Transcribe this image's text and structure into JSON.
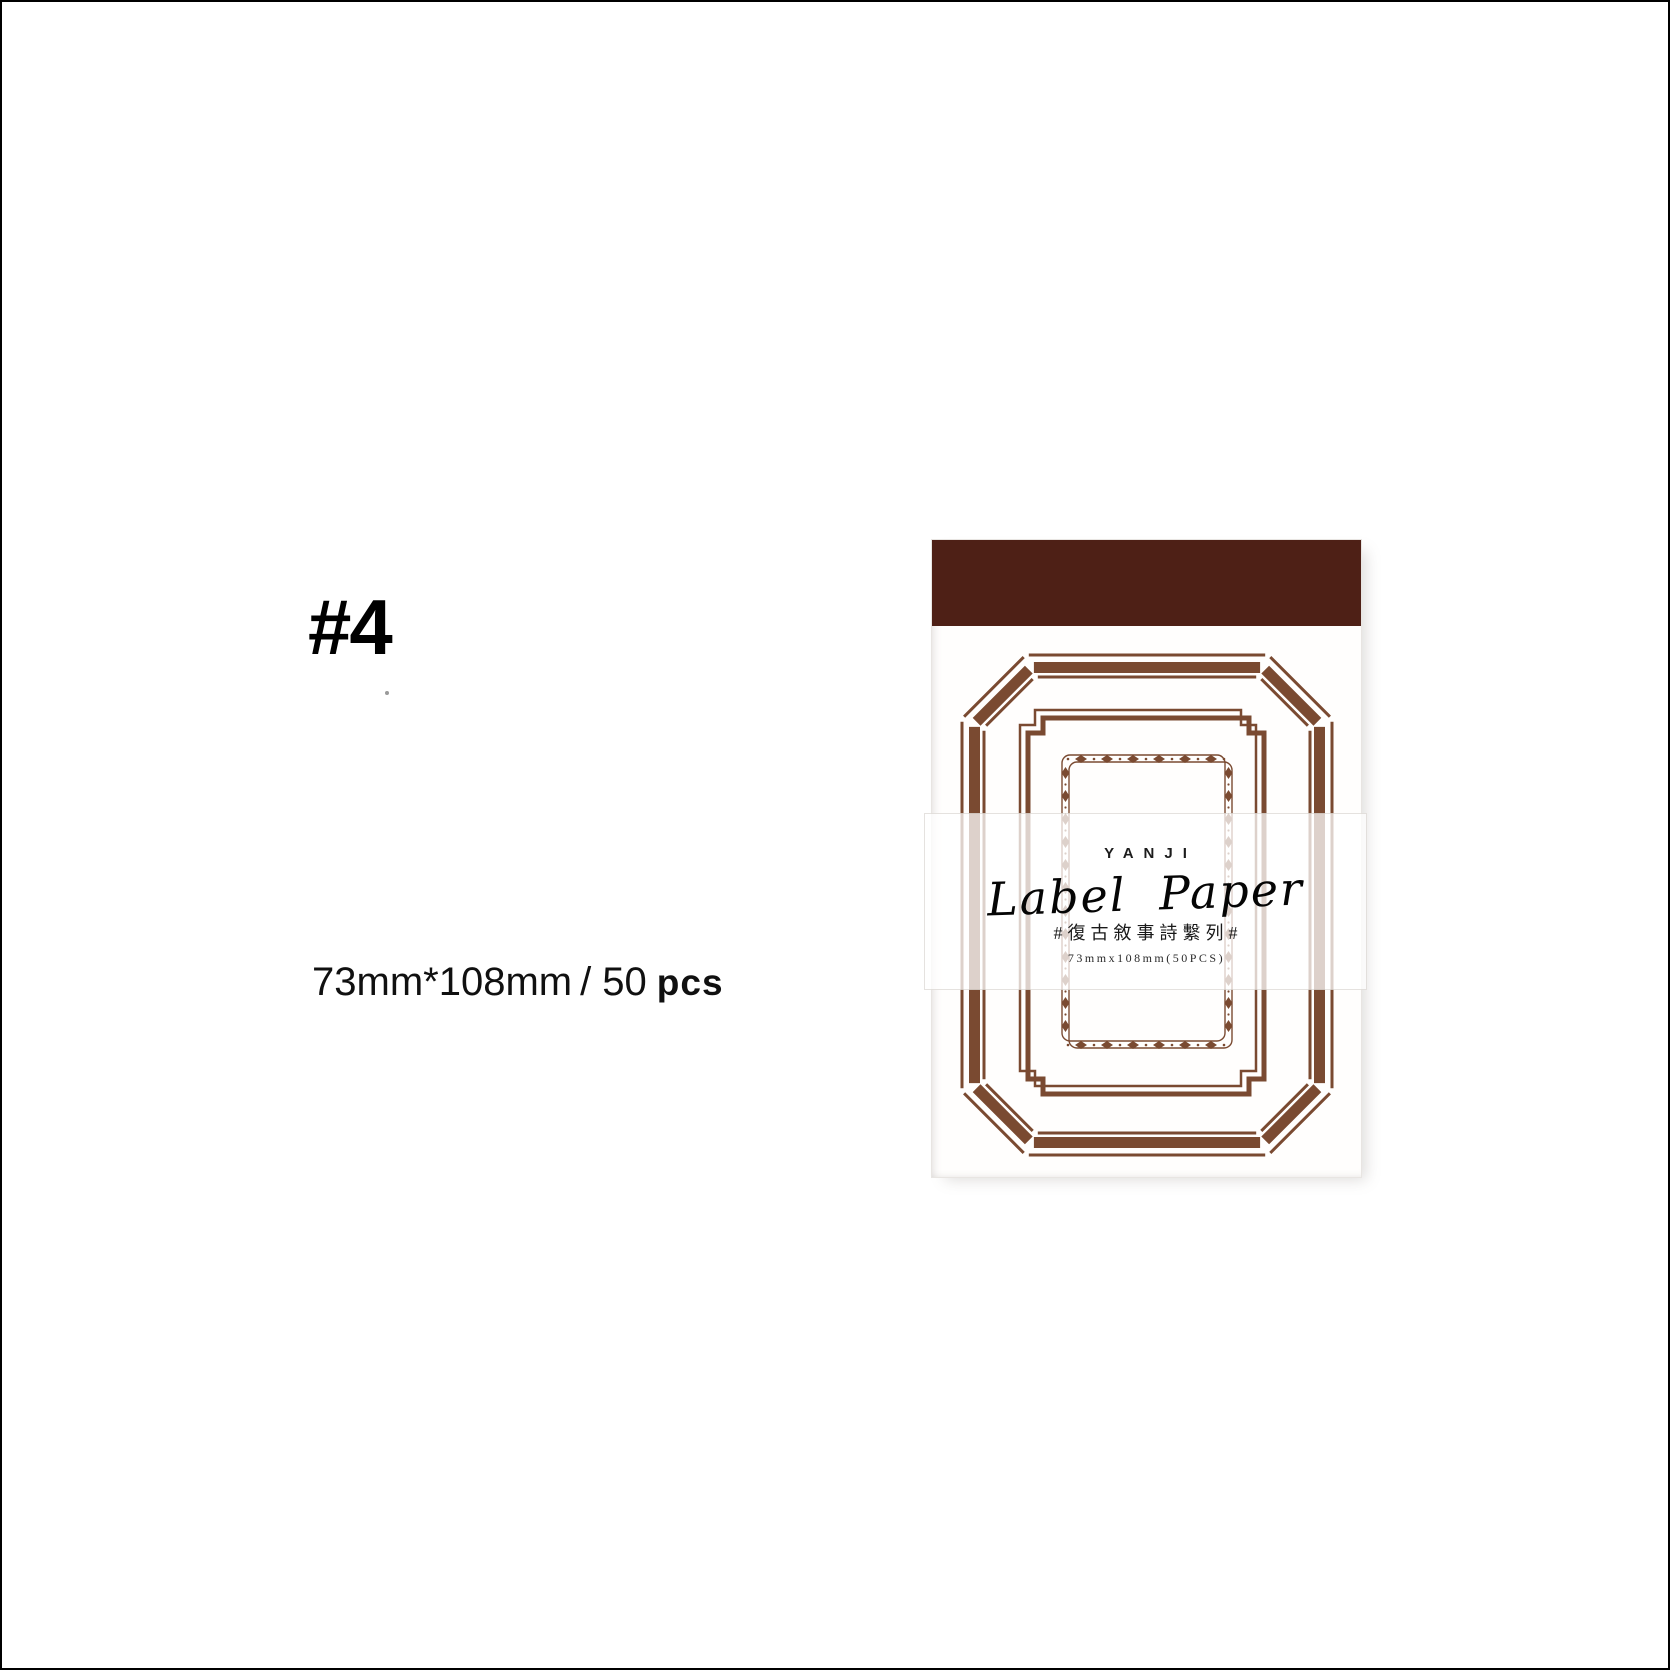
{
  "page": {
    "background": "#ffffff",
    "border_color": "#000000"
  },
  "left_panel": {
    "index_label": "#4",
    "size_prefix": "73mm*108mm",
    "size_mid": "/ 50",
    "size_unit": "pcs"
  },
  "product": {
    "colors": {
      "header_bar": "#4e2016",
      "frame": "#7a4a31",
      "paper": "#fffefd"
    },
    "band": {
      "brand": "YANJI",
      "title": "Label Paper",
      "series": "#復古敘事詩繫列#",
      "spec": "73mmx108mm(50PCS)"
    }
  }
}
